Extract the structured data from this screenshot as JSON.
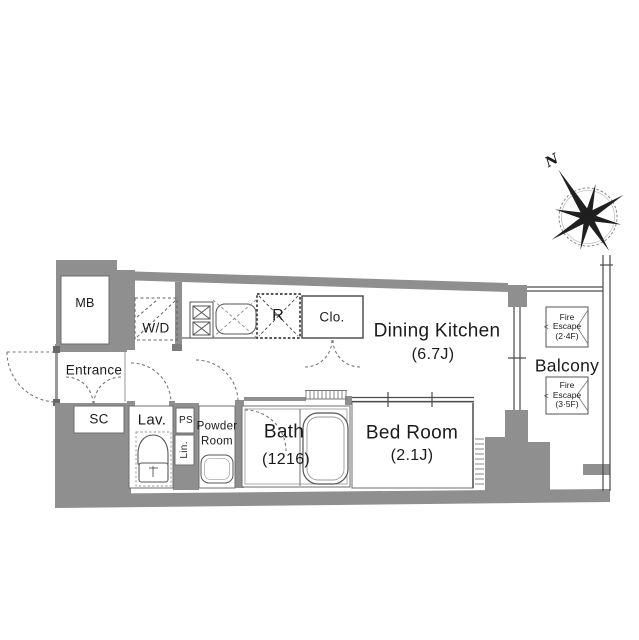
{
  "plan": {
    "rooms": {
      "mb": "MB",
      "wd": "W/D",
      "entrance": "Entrance",
      "sc": "SC",
      "lav": "Lav.",
      "ps": "PS",
      "lin": "Lin.",
      "powder_room_line1": "Powder",
      "powder_room_line2": "Room",
      "bath": "Bath",
      "bath_size": "(1216)",
      "bed_room": "Bed Room",
      "bed_room_size": "(2.1J)",
      "dining_kitchen": "Dining Kitchen",
      "dining_kitchen_size": "(6.7J)",
      "refrigerator": "R",
      "closet": "Clo.",
      "balcony": "Balcony"
    },
    "fire_escape_upper": {
      "line1": "Fire",
      "arrow": "<",
      "line2": "Escape",
      "line3": "(2·4F)"
    },
    "fire_escape_lower": {
      "line1": "Fire",
      "arrow": "<",
      "line2": "Escape",
      "line3": "(3·5F)"
    },
    "compass": {
      "north": "N"
    },
    "colors": {
      "wall": "#8f8f8f",
      "line": "#4a4a4a",
      "text": "#1b1b1b"
    }
  }
}
